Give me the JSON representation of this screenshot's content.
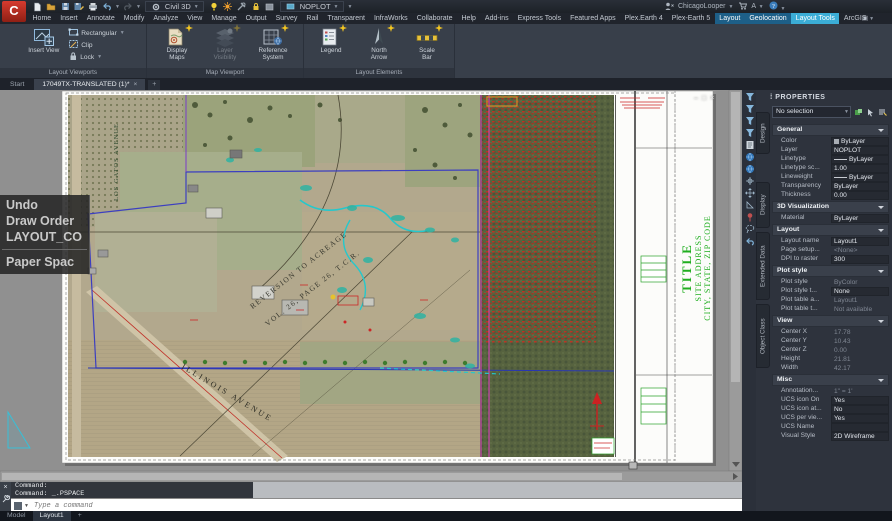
{
  "window": {
    "app_button": "C",
    "workspace": "Civil 3D",
    "layer_control": "NOPLOT",
    "app_title": "Autodesk Civil 3D 2020",
    "doc_title": "17049TX-TRANSLATED (1).dwg",
    "search_placeholder": "Type a keyword or phrase",
    "user_name": "ChicagoLooper",
    "qat_icons": [
      "file-new",
      "folder-open",
      "save",
      "save-as",
      "plot",
      "undo",
      "redo"
    ],
    "state_icons": [
      "bulb",
      "sun",
      "tools",
      "lock",
      "swatch"
    ],
    "window_buttons": [
      "–",
      "□",
      "×"
    ]
  },
  "ribbon_tabs": [
    {
      "label": "Home",
      "state": "normal"
    },
    {
      "label": "Insert",
      "state": "normal"
    },
    {
      "label": "Annotate",
      "state": "normal"
    },
    {
      "label": "Modify",
      "state": "normal"
    },
    {
      "label": "Analyze",
      "state": "normal"
    },
    {
      "label": "View",
      "state": "normal"
    },
    {
      "label": "Manage",
      "state": "normal"
    },
    {
      "label": "Output",
      "state": "normal"
    },
    {
      "label": "Survey",
      "state": "normal"
    },
    {
      "label": "Rail",
      "state": "normal"
    },
    {
      "label": "Transparent",
      "state": "normal"
    },
    {
      "label": "InfraWorks",
      "state": "normal"
    },
    {
      "label": "Collaborate",
      "state": "normal"
    },
    {
      "label": "Help",
      "state": "normal"
    },
    {
      "label": "Add-ins",
      "state": "normal"
    },
    {
      "label": "Express Tools",
      "state": "normal"
    },
    {
      "label": "Featured Apps",
      "state": "normal"
    },
    {
      "label": "Plex.Earth 4",
      "state": "normal"
    },
    {
      "label": "Plex-Earth 5",
      "state": "normal"
    },
    {
      "label": "Layout",
      "state": "highlight"
    },
    {
      "label": "Geolocation",
      "state": "highlight"
    },
    {
      "label": "Layout Tools",
      "state": "active"
    },
    {
      "label": "ArcGIS",
      "state": "normal"
    }
  ],
  "ribbon_panels": [
    {
      "title": "Layout Viewports",
      "width": 146,
      "big": [
        {
          "lines": [
            "Insert View"
          ],
          "icon": "insert-view",
          "dropdown": false,
          "star": false,
          "disabled": false
        }
      ],
      "small": [
        {
          "label": "Rectangular",
          "icon": "rectangular",
          "dropdown": true
        },
        {
          "label": "Clip",
          "icon": "clip",
          "dropdown": false
        },
        {
          "label": "Lock",
          "icon": "lock",
          "dropdown": true
        }
      ]
    },
    {
      "title": "Map Viewport",
      "width": 156,
      "big": [
        {
          "lines": [
            "Display",
            "Maps"
          ],
          "icon": "display-maps",
          "dropdown": true,
          "star": true,
          "disabled": false
        },
        {
          "lines": [
            "Layer",
            "Visibility"
          ],
          "icon": "layer-visibility",
          "dropdown": true,
          "star": true,
          "disabled": true
        },
        {
          "lines": [
            "Reference",
            "System"
          ],
          "icon": "reference-system",
          "dropdown": false,
          "star": true,
          "disabled": false
        }
      ],
      "small": []
    },
    {
      "title": "Layout Elements",
      "width": 150,
      "big": [
        {
          "lines": [
            "Legend"
          ],
          "icon": "legend",
          "dropdown": true,
          "star": true,
          "disabled": false
        },
        {
          "lines": [
            "North",
            "Arrow"
          ],
          "icon": "north-arrow",
          "dropdown": true,
          "star": true,
          "disabled": false
        },
        {
          "lines": [
            "Scale",
            "Bar"
          ],
          "icon": "scale-bar",
          "dropdown": true,
          "star": true,
          "disabled": false
        }
      ],
      "small": []
    }
  ],
  "file_tabs": {
    "tabs": [
      {
        "label": "Start",
        "active": false,
        "closable": false
      },
      {
        "label": "17049TX-TRANSLATED (1)*",
        "active": true,
        "closable": true
      }
    ],
    "new_tab": "+"
  },
  "context_menu": {
    "items": [
      "Undo",
      "Draw Order",
      "LAYOUT_CO"
    ],
    "below_separator": [
      "Paper Spac"
    ]
  },
  "map": {
    "street_label_1": "ILLINOIS  AVENUE",
    "street_label_2": "LOS GATOS AVENUE",
    "note_line_1": "REVERSION TO ACREAGE",
    "note_line_2": "VOL. 26, PAGE 26, T.C.R.",
    "titleblock_title": "TITLE",
    "titleblock_address": "SITE ADDRESS",
    "titleblock_city": "CITY, STATE, ZIP CODE"
  },
  "viewport_controls": [
    "–",
    "□",
    "×"
  ],
  "side_toolbar_icons": [
    "funnel",
    "funnel",
    "funnel",
    "funnel",
    "document",
    "globe",
    "globe",
    "crosshair",
    "arrows",
    "angle",
    "pin",
    "lasso",
    "undo"
  ],
  "command_line": {
    "history": [
      "Command:",
      "Command:  _.PSPACE"
    ],
    "placeholder": "Type a command"
  },
  "status_bar": {
    "tabs": [
      {
        "label": "Model",
        "active": false
      },
      {
        "label": "Layout1",
        "active": true
      }
    ],
    "new_tab": "+"
  },
  "properties_panel": {
    "title": "PROPERTIES",
    "selector": "No selection",
    "side_tabs": [
      "Design",
      "Display",
      "Extended Data",
      "Object Class"
    ],
    "sections": [
      {
        "title": "General",
        "rows": [
          {
            "label": "Color",
            "value": "ByLayer",
            "prefix": "swatch",
            "dim": false
          },
          {
            "label": "Layer",
            "value": "NOPLOT",
            "prefix": null,
            "dim": false
          },
          {
            "label": "Linetype",
            "value": "ByLayer",
            "prefix": "line",
            "dim": false
          },
          {
            "label": "Linetype sc...",
            "value": "1.00",
            "prefix": null,
            "dim": false
          },
          {
            "label": "Lineweight",
            "value": "ByLayer",
            "prefix": "line",
            "dim": false
          },
          {
            "label": "Transparency",
            "value": "ByLayer",
            "prefix": null,
            "dim": false
          },
          {
            "label": "Thickness",
            "value": "0.00",
            "prefix": null,
            "dim": false
          }
        ]
      },
      {
        "title": "3D Visualization",
        "rows": [
          {
            "label": "Material",
            "value": "ByLayer",
            "prefix": null,
            "dim": false
          }
        ]
      },
      {
        "title": "Layout",
        "rows": [
          {
            "label": "Layout name",
            "value": "Layout1",
            "prefix": null,
            "dim": false
          },
          {
            "label": "Page setup...",
            "value": "<None>",
            "prefix": null,
            "dim": true
          },
          {
            "label": "DPI to raster",
            "value": "300",
            "prefix": null,
            "dim": false
          }
        ]
      },
      {
        "title": "Plot style",
        "rows": [
          {
            "label": "Plot style",
            "value": "ByColor",
            "prefix": null,
            "dim": true
          },
          {
            "label": "Plot style t...",
            "value": "None",
            "prefix": null,
            "dim": false
          },
          {
            "label": "Plot table a...",
            "value": "Layout1",
            "prefix": null,
            "dim": true
          },
          {
            "label": "Plot table t...",
            "value": "Not available",
            "prefix": null,
            "dim": true
          }
        ]
      },
      {
        "title": "View",
        "rows": [
          {
            "label": "Center X",
            "value": "17.78",
            "prefix": null,
            "dim": true
          },
          {
            "label": "Center Y",
            "value": "10.43",
            "prefix": null,
            "dim": true
          },
          {
            "label": "Center Z",
            "value": "0.00",
            "prefix": null,
            "dim": true
          },
          {
            "label": "Height",
            "value": "21.81",
            "prefix": null,
            "dim": true
          },
          {
            "label": "Width",
            "value": "42.17",
            "prefix": null,
            "dim": true
          }
        ]
      },
      {
        "title": "Misc",
        "rows": [
          {
            "label": "Annotation...",
            "value": "1\" = 1'",
            "prefix": null,
            "dim": true
          },
          {
            "label": "UCS icon On",
            "value": "Yes",
            "prefix": null,
            "dim": false
          },
          {
            "label": "UCS icon at...",
            "value": "No",
            "prefix": null,
            "dim": false
          },
          {
            "label": "UCS per vie...",
            "value": "Yes",
            "prefix": null,
            "dim": false
          },
          {
            "label": "UCS Name",
            "value": "",
            "prefix": null,
            "dim": false
          },
          {
            "label": "Visual Style",
            "value": "2D Wireframe",
            "prefix": null,
            "dim": false
          }
        ]
      }
    ]
  },
  "colors": {
    "active_tab_blue": "#3badd6",
    "highlight_tab_blue": "#1d5f88",
    "star_yellow": "#f2c521",
    "paper_white": "#fcfcfa",
    "magenta_line": "#df3fc3",
    "boundary_blue": "#3c3fc0",
    "cad_green": "#1fae1f",
    "cad_red": "#cc2626"
  }
}
